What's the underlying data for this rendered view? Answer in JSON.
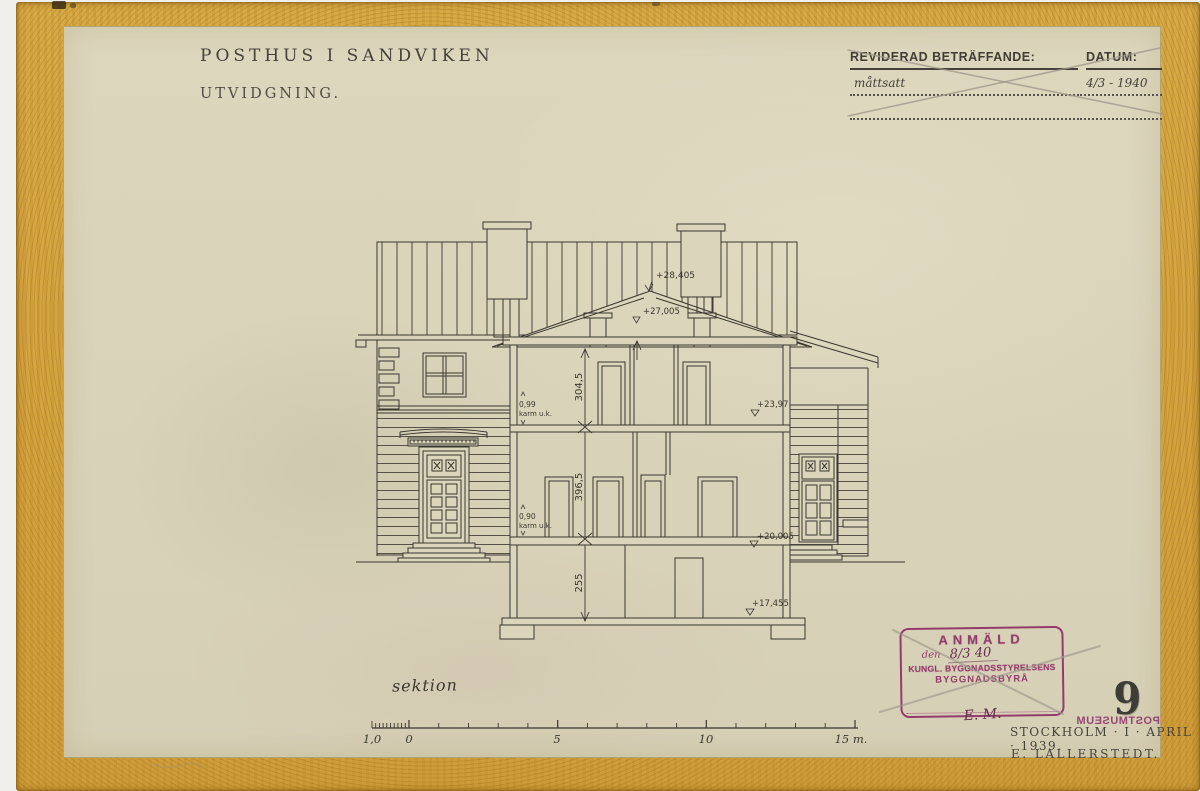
{
  "page": {
    "sheet_number": "9",
    "paper_color": "#d9d3ba",
    "tape_color": "#d2a23e",
    "ink_color": "#3c382f",
    "stamp_color": "#8e3066"
  },
  "title": {
    "project": "POSTHUS I SANDVIKEN",
    "subtitle": "UTVIDGNING."
  },
  "revision_block": {
    "col1_header": "REVIDERAD BETRÄFFANDE:",
    "col2_header": "DATUM:",
    "rows": [
      {
        "subject": "måttsatt",
        "date": "4/3 - 1940"
      },
      {
        "subject": "",
        "date": ""
      }
    ]
  },
  "drawing": {
    "label": "sektion",
    "elevations": [
      "+28,405",
      "+27,005",
      "+23,97",
      "+20,005",
      "+17,455"
    ],
    "dimensions": [
      "304,5",
      "396,5",
      "255"
    ],
    "annotations": [
      {
        "value": "0,99",
        "text": "karm u.k."
      },
      {
        "value": "0,90",
        "text": "karm u.k."
      }
    ]
  },
  "scale_bar": {
    "labels": [
      "1,0",
      "0",
      "5",
      "10",
      "15 m."
    ]
  },
  "approval_stamp": {
    "line1": "ANMÄLD",
    "line2_prefix": "den",
    "line2_value": "8/3 40",
    "line3": "KUNGL. BYGGNADSSTYRELSENS",
    "line4": "BYGGNADSBYRÅ",
    "signature": "E. M."
  },
  "museum_stamp": "POSTMUSEUM",
  "footer": {
    "place_date": "STOCKHOLM · I · APRIL · 1939.",
    "architect": "E. LALLERSTEDT."
  }
}
